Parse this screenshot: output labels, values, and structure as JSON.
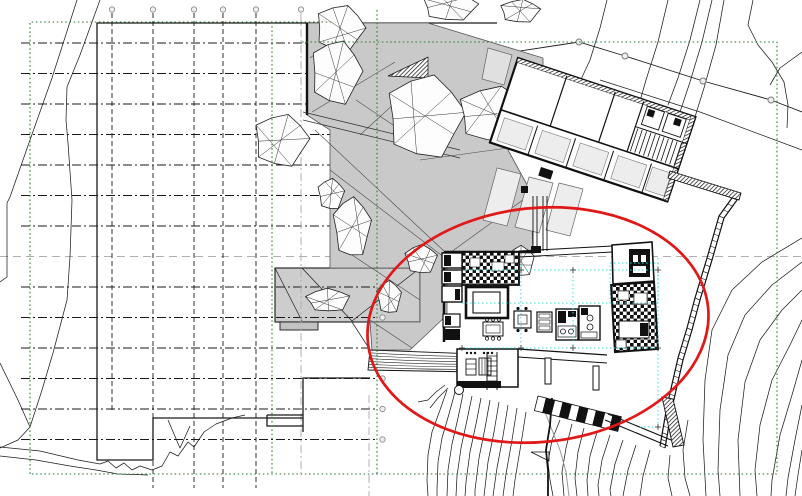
{
  "document": {
    "type": "architectural-site-plan",
    "background": "#ffffff"
  },
  "colors": {
    "ink": "#1a1a1a",
    "contour": "#1c1c1c",
    "gray_line": "#b0b0b0",
    "terrain_fill": "#c9c9c9",
    "terrace_fill": "#cdcdcd",
    "room_fill": "#ededed",
    "green_boundary": "#2e7d32",
    "cyan_ref": "#3fd9d9",
    "red_marker": "#e11818"
  },
  "grid": {
    "h_lines_y": [
      43,
      73.5,
      104,
      134.5,
      165,
      195.5,
      226,
      287,
      317.5,
      348,
      378.5,
      409,
      439.5
    ],
    "h_x1": 21,
    "h_x2": 378,
    "h_end_circle_x": 382.5,
    "gray_h_y": 256.5,
    "v_lines": [
      {
        "x": 112,
        "y1": 13,
        "y2": 410
      },
      {
        "x": 153,
        "y1": 13,
        "y2": 488
      },
      {
        "x": 194,
        "y1": 13,
        "y2": 488
      },
      {
        "x": 223,
        "y1": 13,
        "y2": 488
      },
      {
        "x": 256,
        "y1": 13,
        "y2": 488
      }
    ],
    "gray_v_lines": [
      {
        "x": 301,
        "y1": 13,
        "y2": 474
      },
      {
        "x": 369,
        "y1": 395,
        "y2": 496
      }
    ],
    "top_circle_y": 9.5,
    "circle_r": 2.7
  },
  "survey_boundary": {
    "paths": [
      "M497,23 L97,23 L97,460 L153,460 L153,418 L303,418",
      "M303,432 L303,378 L370,378",
      "M267,415 L303,415",
      "M267,415 L267,426 L303,426"
    ]
  },
  "green_boundary": {
    "outer1": "30,474 30,22 332,22",
    "outer2": "302,42 777,42 777,474 30,474",
    "inner_v1": "272,22 272,474",
    "inner_v2": "377,10 377,474"
  },
  "fence": {
    "line": "432,80 507,53 579,42 625,56 703,81 771,100 802,112",
    "line2": "600,80 700,112 802,150",
    "markers": [
      [
        507,
        53
      ],
      [
        579,
        42
      ],
      [
        625,
        56
      ],
      [
        703,
        81
      ],
      [
        771,
        100
      ]
    ]
  },
  "terrain": {
    "main_polygon": "307,23 428,23 543,58 543,97 508,150 531,192 533,253 447,253 447,315 410,350 372,350 370,322 420,322 420,268 330,268 330,130 307,115",
    "edge_dark": "307,23 307,115",
    "tin_lines": [
      "310,58 347,30",
      "312,112 395,62",
      "315,130 445,252",
      "330,170 445,258",
      "352,255 420,300",
      "360,135 420,80",
      "420,160 508,148",
      "447,255 531,194",
      "370,320 412,348",
      "356,100 430,150"
    ],
    "hatch_wedge": "388,76 428,57 428,78",
    "path_lines": [
      "303,112 460,150",
      "303,120 460,158"
    ],
    "terrace": {
      "x": 275,
      "y": 268,
      "w": 145,
      "h": 54,
      "step": {
        "x": 280,
        "y": 322,
        "w": 38,
        "h": 8
      },
      "diagonals": [
        "302,268 352,321",
        "420,268 352,321",
        "275,268 302,321"
      ]
    },
    "deck": {
      "outline": "370,350 478,354 476,372 368,370",
      "n_lines": 6,
      "tie": "370,350 352,322"
    }
  },
  "trees": [
    {
      "cx": 340,
      "cy": 28,
      "rx": 26,
      "ry": 24
    },
    {
      "cx": 336,
      "cy": 72,
      "rx": 27,
      "ry": 33
    },
    {
      "cx": 281,
      "cy": 140,
      "rx": 29,
      "ry": 27
    },
    {
      "cx": 425,
      "cy": 116,
      "rx": 41,
      "ry": 43
    },
    {
      "cx": 494,
      "cy": 114,
      "rx": 38,
      "ry": 29
    },
    {
      "cx": 450,
      "cy": 6,
      "rx": 29,
      "ry": 15
    },
    {
      "cx": 520,
      "cy": 11,
      "rx": 21,
      "ry": 12
    },
    {
      "cx": 331,
      "cy": 194,
      "rx": 14,
      "ry": 16
    },
    {
      "cx": 352,
      "cy": 227,
      "rx": 20,
      "ry": 31
    },
    {
      "cx": 421,
      "cy": 259,
      "rx": 17,
      "ry": 15
    },
    {
      "cx": 389,
      "cy": 297,
      "rx": 13,
      "ry": 17
    },
    {
      "cx": 521,
      "cy": 261,
      "rx": 14,
      "ry": 16
    },
    {
      "cx": 328,
      "cy": 300,
      "rx": 23,
      "ry": 12
    }
  ],
  "annex": {
    "origin": [
      518,
      58
    ],
    "angle": 18.4,
    "w": 187,
    "h": 89,
    "band_y": 54.5,
    "partitions_x": [
      52,
      103,
      133
    ],
    "lower_partitions_x": [
      40,
      80,
      120,
      160
    ],
    "stair": {
      "x0": 136,
      "x1": 182,
      "step": 4.6,
      "y0": 29,
      "y1": 53,
      "mid_y": 28
    },
    "rooms_lower": [
      [
        6,
        61,
        30,
        24
      ],
      [
        46,
        61,
        30,
        24
      ],
      [
        86,
        61,
        30,
        24
      ],
      [
        126,
        61,
        30,
        24
      ],
      [
        162,
        61,
        20,
        24
      ]
    ],
    "south_strips": [
      "497,168 521,174 507,226 483,220",
      "529,177 553,183 539,233 515,227",
      "559,183 583,189 570,236 546,230"
    ],
    "west_wedge": "488,48 512,55 504,85 482,79",
    "black_block": [
      541,
      167,
      13,
      9
    ],
    "corridor_x": [
      533,
      537,
      543,
      547
    ],
    "corridor_y": [
      196,
      251
    ]
  },
  "retaining_wall": {
    "outer": "737,200 724,218 712,260 700,300 692,330 683,360 672,408 665,448",
    "inner": "732,198 719,216 707,258 695,298 687,328 678,358 667,406 660,446",
    "walkway": "670,171 741,193 739,200 668,178"
  },
  "stairs_south": {
    "x": 538,
    "y": 396,
    "angle": 14,
    "len": 86,
    "wid": 15,
    "treads": 10,
    "rail1": "605,420 668,446",
    "rail2": "608,414 671,440",
    "end_bar": "662,397 673,399 684,445 673,447"
  },
  "cyan": {
    "h": [
      [
        462,
        270,
        658
      ],
      [
        462,
        303,
        613
      ],
      [
        462,
        348,
        658
      ],
      [
        640,
        427,
        658
      ]
    ],
    "v": [
      [
        521,
        265,
        350
      ],
      [
        573,
        268,
        348
      ],
      [
        658,
        258,
        427
      ]
    ],
    "rect": [
      610,
      263,
      48,
      40
    ],
    "crosses": [
      [
        521,
        270
      ],
      [
        573,
        270
      ],
      [
        521,
        348
      ],
      [
        573,
        348
      ],
      [
        658,
        270
      ],
      [
        658,
        348
      ],
      [
        462,
        270
      ],
      [
        462,
        348
      ],
      [
        658,
        427
      ]
    ]
  },
  "contours": {
    "black": [
      "77,0 52,78 30,140 10,197 7,203 7,277 0,282",
      "100,0 80,55 67,87 66,120 68,143 72,200 70,257 67,300 53,353 42,390 30,427 18,440 0,448",
      "0,363 18,400 30,427",
      "0,447 40,451 78,460 100,464 108,461 116,468 124,463 132,470 140,466 152,470",
      "152,470 162,466 170,452 178,456 188,442 194,447 204,432 216,424 232,418 245,415",
      "0,456 36,460 70,466 96,470 118,474 148,475",
      "168,420 180,448 190,426",
      "607,0 600,28 590,60 577,88",
      "668,0 658,42 646,80 638,108",
      "700,0 690,40 678,78 668,105",
      "712,0 702,42 690,82 680,112",
      "724,0 716,45 704,88 694,120",
      "753,0 748,25 758,45 772,62 784,82 788,105 787,128",
      "802,52 780,68 770,85",
      "802,238 762,262 732,290 712,330 705,380 703,440 706,496",
      "802,262 772,285 745,315 728,355 720,410 718,470 720,496",
      "802,290 782,310 760,340 745,382 738,440 740,496",
      "802,320 790,345 772,380 760,425 755,470 757,496",
      "802,360 792,395 780,435 772,480 771,496",
      "802,405 795,440 788,478 786,496",
      "802,450 798,475 795,496",
      "688,420 683,450 685,478 690,496",
      "670,455 668,478 672,496",
      "560,420 552,440 548,462 550,480 553,496",
      "572,424 566,448 562,472 564,496",
      "584,428 578,452 575,478 577,496",
      "597,432 590,456 587,480 588,496",
      "610,435 602,460 598,485 599,496",
      "623,440 615,464 610,490 611,496",
      "636,445 628,470 623,496",
      "650,450 643,476 640,496",
      "447,390 440,410 432,432 428,455 427,480 428,496",
      "455,392 449,414 442,438 438,462 437,490 437,496",
      "463,394 458,418 452,444 448,470 447,496",
      "472,396 467,420 461,448 457,476 456,496",
      "481,398 476,424 470,452 466,482 465,496",
      "490,400 485,428 479,458 475,490 475,496",
      "499,402 494,432 488,462 484,496",
      "508,405 503,436 497,468 493,496",
      "517,408 512,440 506,474 503,496",
      "526,412 521,444 515,480 513,496",
      "445,385 436,392 428,400 418,402",
      "448,388 438,398 430,408"
    ],
    "gray": [
      "545,412 552,430 560,450 566,472 569,496"
    ],
    "property_line": "552,398 550,425 546,450 548,470 548,496",
    "triangle": "531,452 549,452 549,461"
  },
  "red_marker_ellipse": {
    "cx": 538,
    "cy": 325,
    "rx": 171,
    "ry": 117,
    "rot": -6,
    "sw": 2.7
  }
}
